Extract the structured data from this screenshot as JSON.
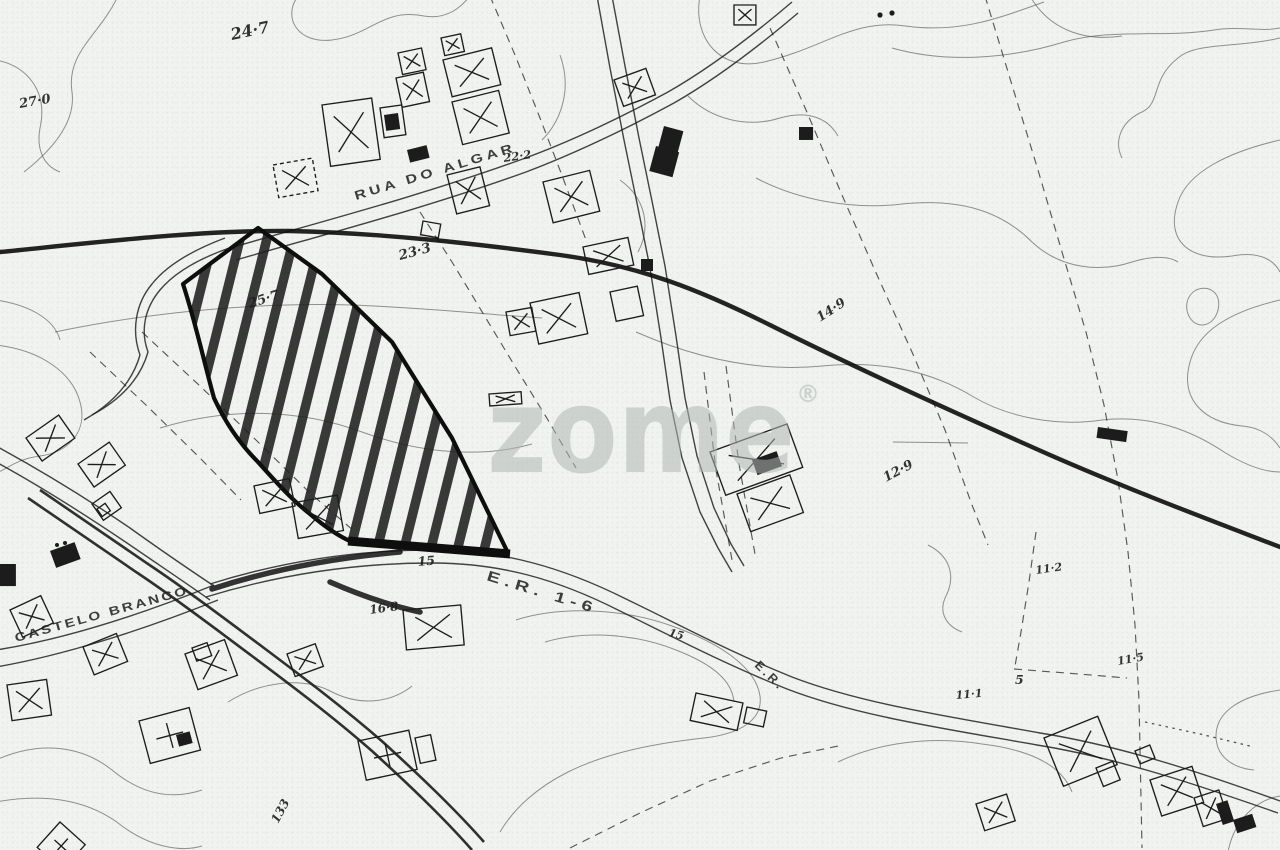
{
  "map": {
    "type": "scanned cadastral / location plan, black ink on paper",
    "watermark": {
      "text": "zome",
      "registered": "®",
      "color": "#b2b8b3"
    },
    "colors": {
      "ink": "#1c1c1c",
      "paper": "#f1f3f0",
      "plot_hatch": "#1f1f1f"
    },
    "labels": [
      {
        "id": "elev-24-7",
        "text": "24·7"
      },
      {
        "id": "elev-27-0",
        "text": "27·0"
      },
      {
        "id": "street-rua-do-algar",
        "text": "RUA DO ALGAR"
      },
      {
        "id": "elev-22-2",
        "text": "22·2"
      },
      {
        "id": "elev-23-3",
        "text": "23·3"
      },
      {
        "id": "elev-25-7",
        "text": "25·7"
      },
      {
        "id": "elev-14-9",
        "text": "14·9"
      },
      {
        "id": "elev-12-9",
        "text": "12·9"
      },
      {
        "id": "elev-16-8",
        "text": "16·8"
      },
      {
        "id": "elev-15",
        "text": "15"
      },
      {
        "id": "road-er-1-6",
        "text": "E.R. 1-6"
      },
      {
        "id": "street-castelo-branco",
        "text": "CASTELO BRANCO"
      },
      {
        "id": "num-133",
        "text": "133"
      },
      {
        "id": "elev-11-2",
        "text": "11·2"
      },
      {
        "id": "elev-11-5",
        "text": "11·5"
      },
      {
        "id": "elev-11-1",
        "text": "11·1"
      },
      {
        "id": "num-5",
        "text": "5"
      },
      {
        "id": "elev-15b",
        "text": "15"
      },
      {
        "id": "road-er-2",
        "text": "E.R."
      }
    ],
    "legend_note": "hatched area = subject plot; rectangles with X = buildings"
  }
}
